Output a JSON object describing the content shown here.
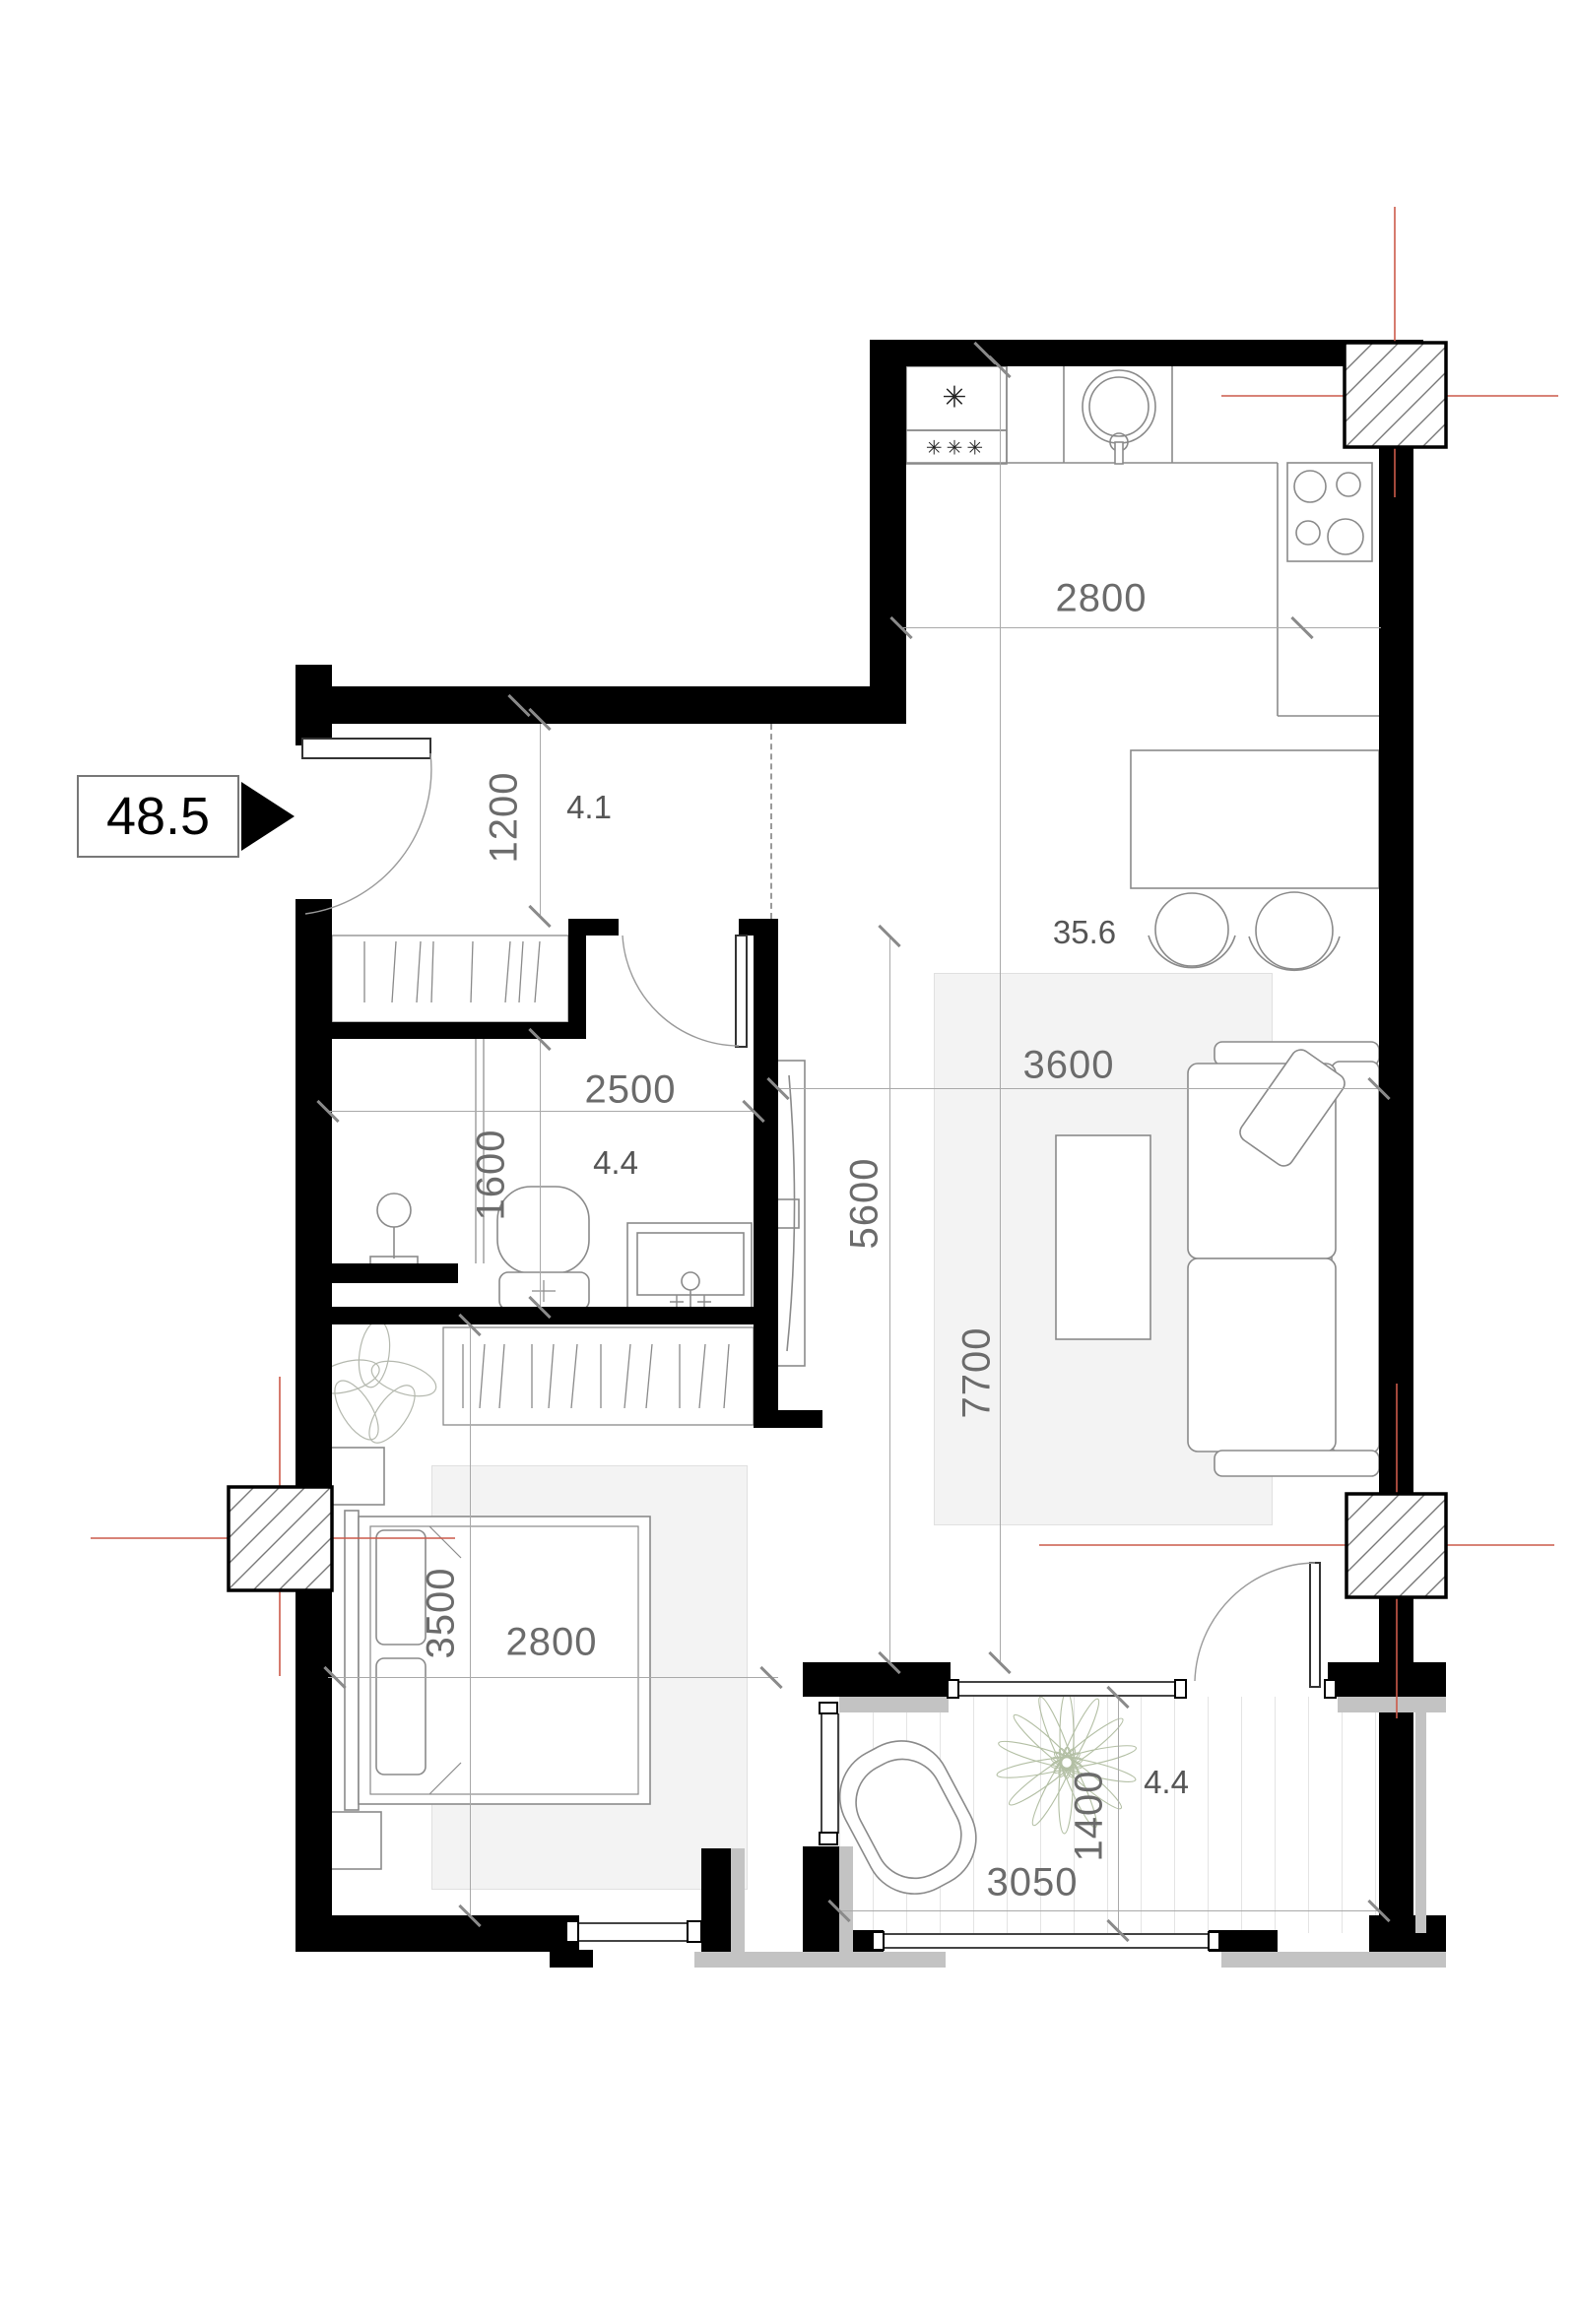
{
  "badge": {
    "total_area": "48.5"
  },
  "rooms": {
    "hall": {
      "area": "4.1"
    },
    "bathroom": {
      "area": "4.4"
    },
    "living": {
      "area": "35.6"
    },
    "balcony": {
      "area": "4.4"
    }
  },
  "dims": {
    "kitchen_width": "2800",
    "hall_depth": "1200",
    "bathroom_width": "2500",
    "bathroom_depth": "1600",
    "left_zone_depth": "5600",
    "living_width": "3600",
    "living_depth": "7700",
    "bedroom_depth": "3500",
    "bedroom_width": "2800",
    "balcony_width": "3050",
    "balcony_depth": "1400"
  },
  "symbols": {
    "fridge_top": "✳",
    "fridge_bottom": "✳✳✳"
  },
  "colors": {
    "wall": "#000000",
    "dimension_text": "#6b6b6b",
    "axis_red": "#cc5a4a",
    "rug_fill": "#f3f3f3",
    "parapet_gray": "#c3c3c3",
    "furniture_stroke": "#8a8a8a"
  }
}
